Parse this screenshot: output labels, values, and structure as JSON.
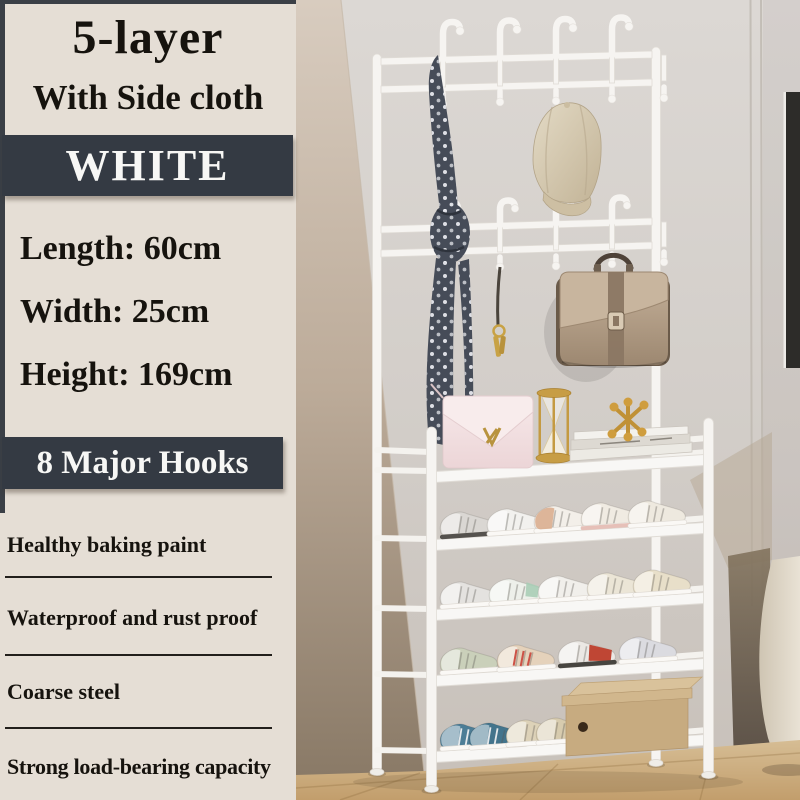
{
  "panel": {
    "title": "5-layer",
    "subtitle": "With Side cloth",
    "color_badge": "WHITE",
    "dimensions": [
      "Length: 60cm",
      "Width: 25cm",
      "Height: 169cm"
    ],
    "hooks_badge": "8 Major Hooks",
    "features": [
      "Healthy baking paint",
      "Waterproof and rust proof",
      "Coarse steel",
      "Strong load-bearing capacity"
    ],
    "colors": {
      "panel_background": "#e5ded5",
      "badge_background": "#343a43",
      "badge_text": "#f7f7f5",
      "text": "#16130e",
      "rack_white": "#f6f4f1"
    }
  },
  "photo": {
    "items": [
      "coat-rack-with-hooks",
      "polka-dot-scarf",
      "beige-cap",
      "taupe-handbag",
      "gold-keychain",
      "pink-purse",
      "gold-hourglass",
      "gold-jack-decor",
      "book-stack",
      "sneaker-shelves",
      "cardboard-shoe-box",
      "wood-floor",
      "wall-frame",
      "side-furniture"
    ]
  }
}
